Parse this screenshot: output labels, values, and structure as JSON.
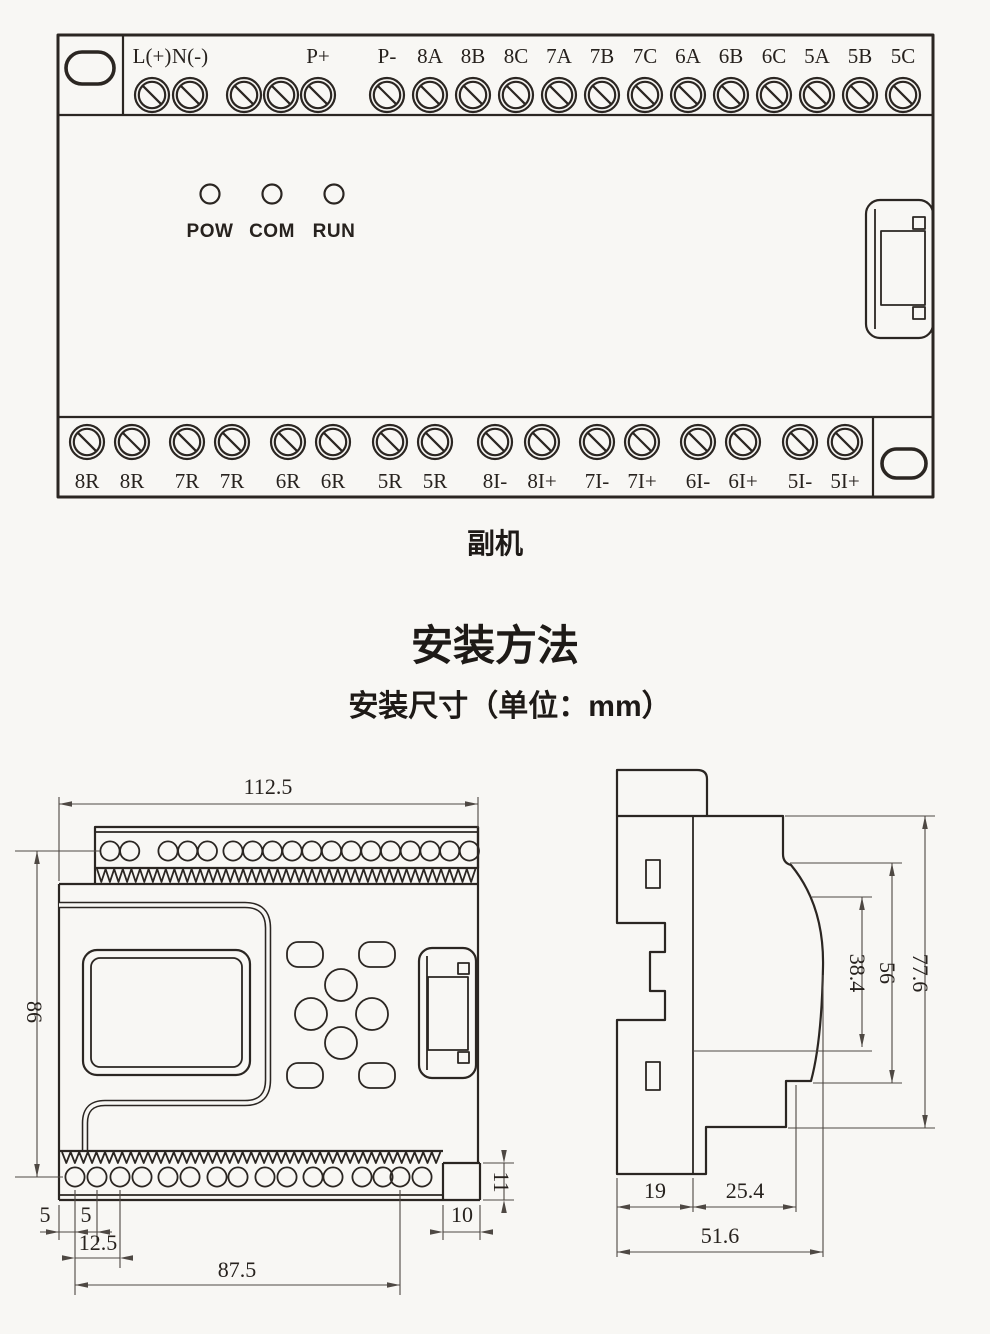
{
  "colors": {
    "background": "#f8f7f4",
    "line": "#2b2622",
    "dim_line": "#4e4843",
    "text": "#27221e"
  },
  "device_panel": {
    "top_terminal_labels": [
      "L(+)",
      "N(-)",
      "",
      "",
      "P+",
      "P-",
      "8A",
      "8B",
      "8C",
      "7A",
      "7B",
      "7C",
      "6A",
      "6B",
      "6C",
      "5A",
      "5B",
      "5C"
    ],
    "led_labels": [
      "POW",
      "COM",
      "RUN"
    ],
    "bottom_terminal_labels": [
      "8R",
      "8R",
      "7R",
      "7R",
      "6R",
      "6R",
      "5R",
      "5R",
      "8I-",
      "8I+",
      "7I-",
      "7I+",
      "6I-",
      "6I+",
      "5I-",
      "5I+"
    ],
    "caption": "副机"
  },
  "install_section": {
    "title": "安装方法",
    "subtitle": "安装尺寸（单位：mm）"
  },
  "front_view_dims": {
    "overall_width": "112.5",
    "overall_height": "86",
    "edge_to_first_hole": "5",
    "hole_pitch": "5",
    "two_hole_pitch": "12.5",
    "hole_row_span": "87.5",
    "step_width": "10",
    "step_height": "11"
  },
  "side_view_dims": {
    "overall_height": "77.6",
    "body_height": "56",
    "recess_height": "38.4",
    "base_depth": "19",
    "front_depth": "25.4",
    "overall_depth": "51.6"
  }
}
